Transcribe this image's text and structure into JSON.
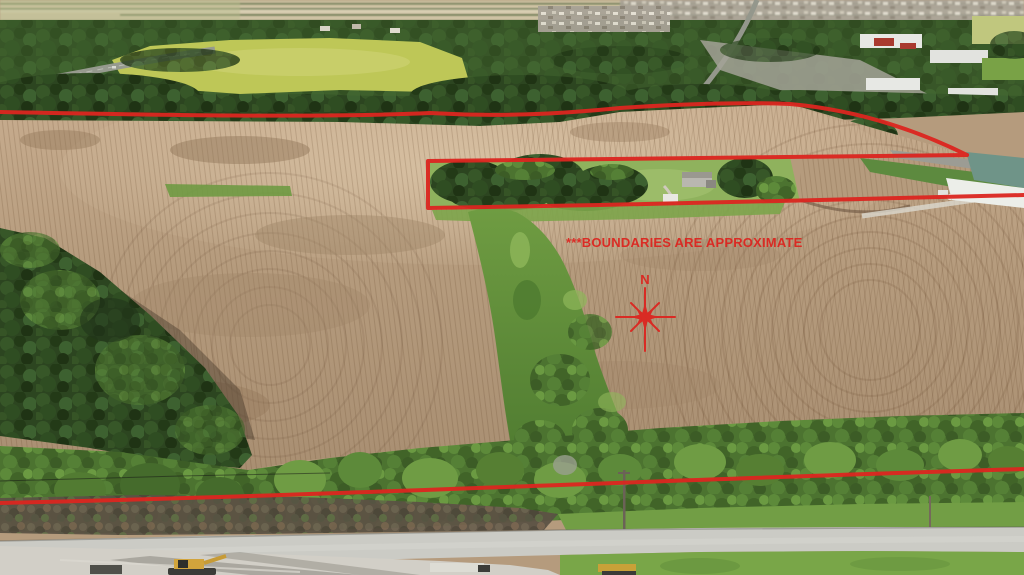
{
  "photo_overlay": {
    "boundary_note": "***BOUNDARIES ARE APPROXIMATE",
    "compass_label": "N"
  },
  "colors": {
    "annotation_red": "#dc2620",
    "corn_tan": "#b59b7d",
    "corn_light": "#c7ac8e",
    "tree_dark_green": "#2c4520",
    "tree_mid_green": "#4c7330",
    "grass_bright": "#79a648",
    "yellow_field": "#bec757",
    "road_gray": "#cbcbc5",
    "gravel_gray": "#d2cfc7"
  }
}
